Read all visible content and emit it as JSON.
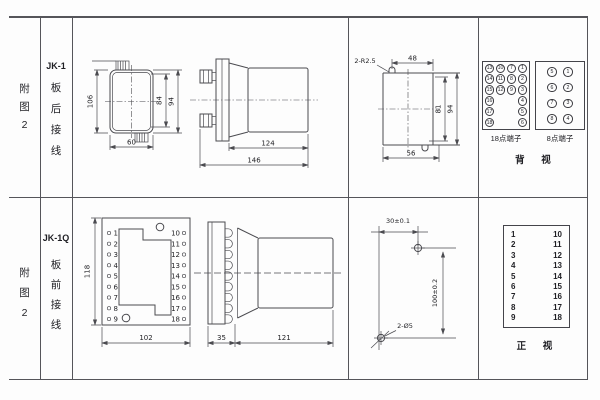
{
  "colors": {
    "line": "#4b4b50",
    "text": "#232327",
    "background": "#fdfdfd"
  },
  "rows": {
    "top": {
      "fig1": "附",
      "fig2": "图",
      "fig3": "2",
      "model": "JK-1",
      "w1": "板",
      "w2": "后",
      "w3": "接",
      "w4": "线"
    },
    "bottom": {
      "fig1": "附",
      "fig2": "图",
      "fig3": "2",
      "model": "JK-1Q",
      "w1": "板",
      "w2": "前",
      "w3": "接",
      "w4": "线"
    }
  },
  "rear_view": {
    "d_height": "106",
    "d_width": "60",
    "d84": "84",
    "d94": "94"
  },
  "side_back": {
    "d124": "124",
    "d146": "146"
  },
  "cutout": {
    "note": "2-R2.5",
    "d48": "48",
    "d56": "56",
    "d81": "81",
    "d94": "94"
  },
  "back_terminals": {
    "t18_label": "18点端子",
    "t8_label": "8点端子",
    "view": "背 视",
    "t18": [
      [
        "13",
        "10",
        "7",
        "1"
      ],
      [
        "14",
        "11",
        "8",
        "2"
      ],
      [
        "15",
        "12",
        "9",
        "3"
      ],
      [
        "16",
        "",
        "",
        "4"
      ],
      [
        "17",
        "",
        "",
        "5"
      ],
      [
        "18",
        "",
        "",
        "6"
      ]
    ],
    "t8": [
      [
        "5",
        "1"
      ],
      [
        "6",
        "2"
      ],
      [
        "7",
        "3"
      ],
      [
        "8",
        "4"
      ]
    ]
  },
  "front_panel": {
    "d118": "118",
    "d102": "102",
    "left": [
      "1",
      "2",
      "3",
      "4",
      "5",
      "6",
      "7",
      "8",
      "9"
    ],
    "right": [
      "10",
      "11",
      "12",
      "13",
      "14",
      "15",
      "16",
      "17",
      "18"
    ]
  },
  "side_front": {
    "d35": "35",
    "d121": "121"
  },
  "drill": {
    "d30": "30±0.1",
    "d100": "100±0.2",
    "holes": "2-Ø5"
  },
  "front_terminals": {
    "view": "正 视",
    "left": [
      "1",
      "2",
      "3",
      "4",
      "5",
      "6",
      "7",
      "8",
      "9"
    ],
    "right": [
      "10",
      "11",
      "12",
      "13",
      "14",
      "15",
      "16",
      "17",
      "18"
    ]
  }
}
